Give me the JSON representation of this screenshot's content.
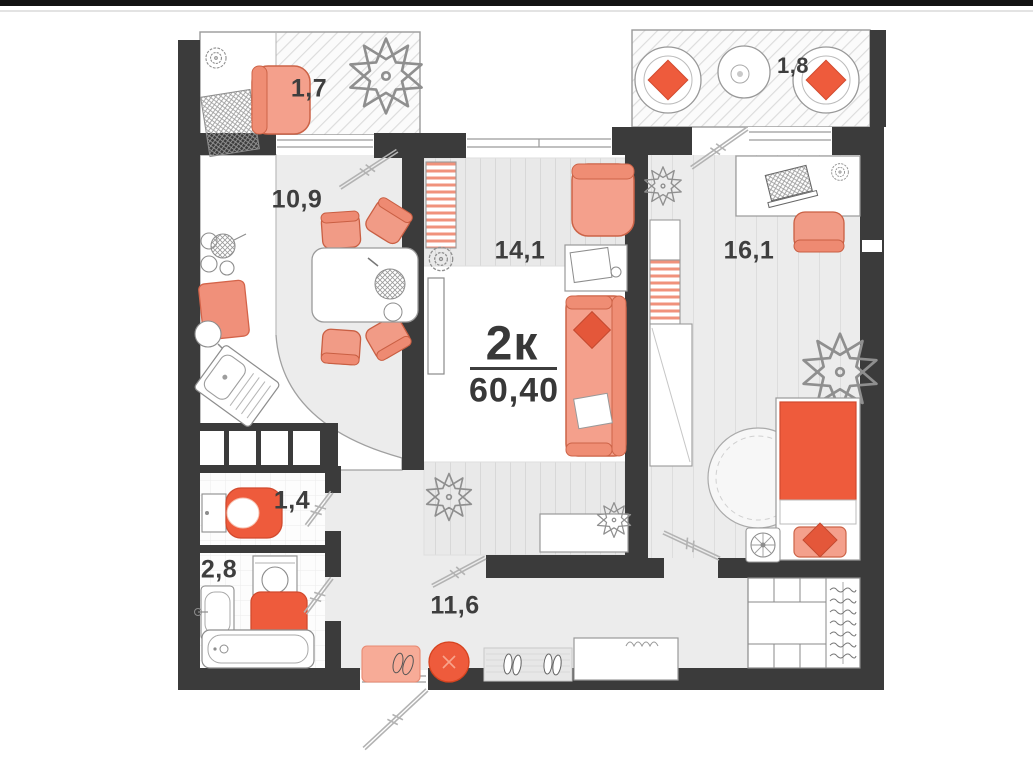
{
  "unit": {
    "type_label": "2к",
    "total_area": "60,40"
  },
  "rooms": [
    {
      "name": "balcony-left",
      "area": "1,7"
    },
    {
      "name": "balcony-right",
      "area": "1,8"
    },
    {
      "name": "kitchen",
      "area": "10,9"
    },
    {
      "name": "bedroom",
      "area": "14,1"
    },
    {
      "name": "living-room",
      "area": "16,1"
    },
    {
      "name": "toilet",
      "area": "1,4"
    },
    {
      "name": "bathroom",
      "area": "2,8"
    },
    {
      "name": "hallway",
      "area": "11,6"
    }
  ],
  "colors": {
    "wall": "#3b3b3b",
    "salmon": "#f4a08c",
    "orange": "#ee5b3c",
    "floor": "#ececec",
    "text": "#3e3e3e"
  }
}
